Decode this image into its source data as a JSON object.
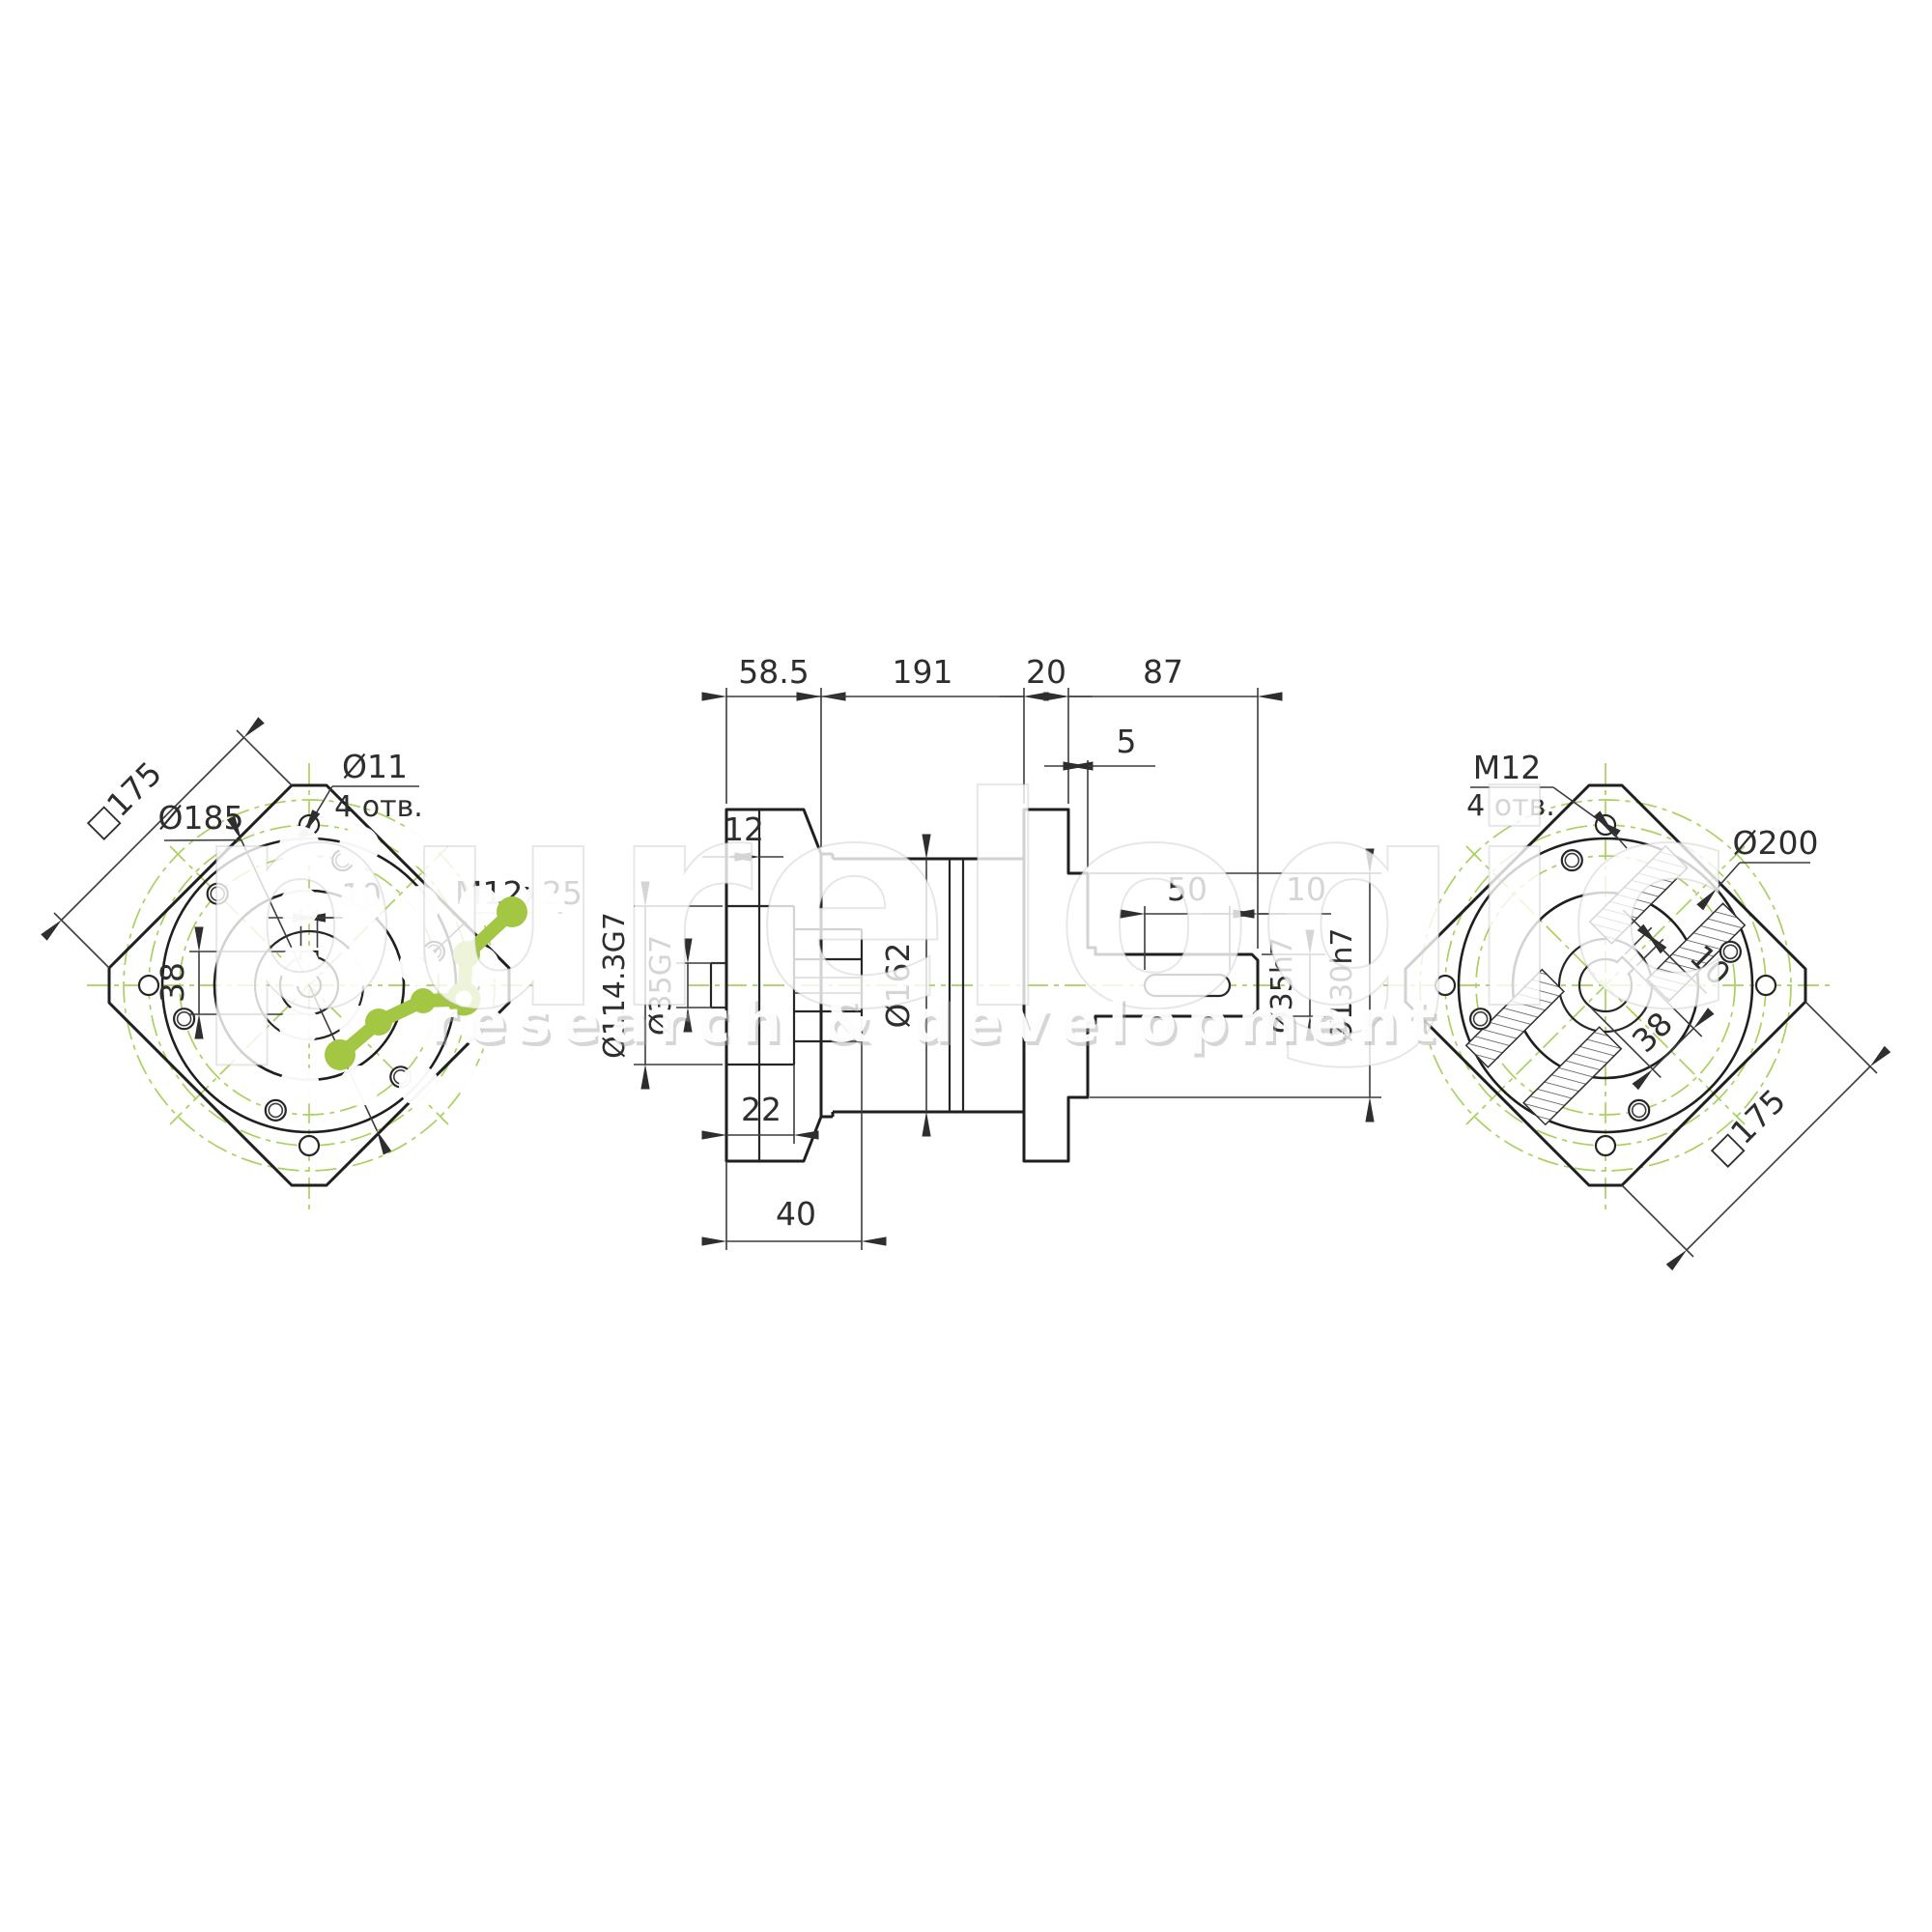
{
  "watermark": {
    "brand": "purelogic",
    "subtitle": "research & development"
  },
  "colors": {
    "line": "#1f1f1f",
    "centerline_green": "#a9d15f",
    "logo_green": "#a3c643",
    "watermark_white": "#ffffff"
  },
  "left_view": {
    "square": "□175",
    "bolt_circle_dia": "Ø185",
    "hole_dia": "Ø11",
    "hole_count": "4 отв.",
    "thread_spec": "M12x25",
    "keyway_width": "10",
    "keyway_height": "38"
  },
  "center_view": {
    "len_input": "58.5",
    "len_body": "191",
    "len_flange": "20",
    "len_shaft": "87",
    "plate_thickness": "12",
    "pilot_protrusion": "5",
    "input_pilot_dia": "Ø114.3G7",
    "input_bore_dia": "Ø35G7",
    "body_dia": "Ø162",
    "recess_depth": "22",
    "input_depth": "40",
    "key_length": "50",
    "key_end_offset": "10",
    "shaft_dia": "Ø35h7",
    "pilot_dia": "Ø130h7"
  },
  "right_view": {
    "thread_spec": "M12",
    "hole_count": "4 отв.",
    "pilot_dia": "Ø200",
    "keyway_width": "10",
    "keyway_height": "38",
    "square": "□175"
  }
}
